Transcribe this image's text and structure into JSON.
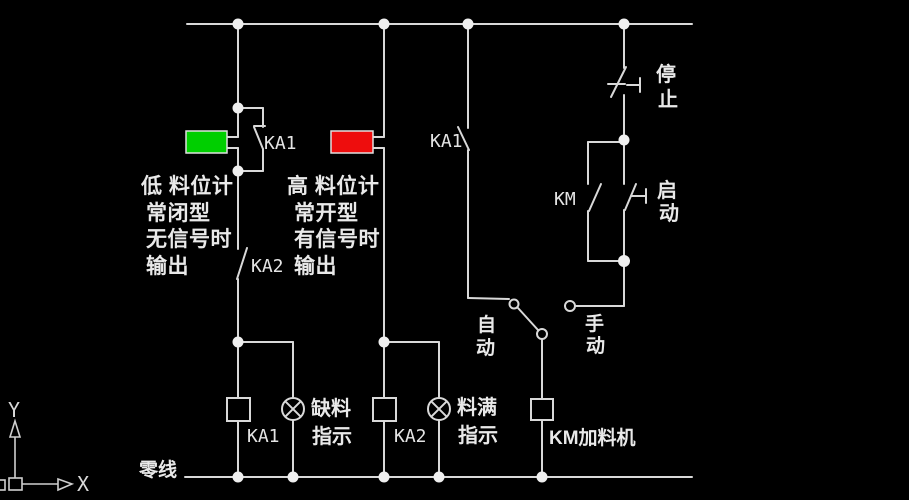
{
  "colors": {
    "background": "#000000",
    "wire": "#d9d9d9",
    "text": "#e9e9e9",
    "low_sensor_fill": "#00cf00",
    "high_sensor_fill": "#ee0d0d"
  },
  "schematic": {
    "low_sensor_branch": {
      "bypass_contact_label": "KA1",
      "series_contact_label": "KA2",
      "note_lines": [
        "低 料位计",
        "常闭型",
        "无信号时",
        "输出"
      ],
      "coil_label": "KA1"
    },
    "high_sensor_branch": {
      "note_lines": [
        "高 料位计",
        "常开型",
        "有信号时",
        "输出"
      ],
      "coil_label": "KA2"
    },
    "lack_lamp_caption": [
      "缺料",
      "指示"
    ],
    "full_lamp_caption": [
      "料满",
      "指示"
    ],
    "auto_branch": {
      "contact_label": "KA1",
      "auto_chars": [
        "自",
        "动"
      ],
      "manual_chars": [
        "手",
        "动"
      ],
      "feeder_label": "KM加料机"
    },
    "control_branch": {
      "stop_chars": [
        "停",
        "止"
      ],
      "start_chars": [
        "启",
        "动"
      ],
      "km_contact_label": "KM"
    },
    "neutral_label": "零线",
    "ucs_axes": {
      "x_label": "X",
      "y_label": "Y"
    }
  }
}
